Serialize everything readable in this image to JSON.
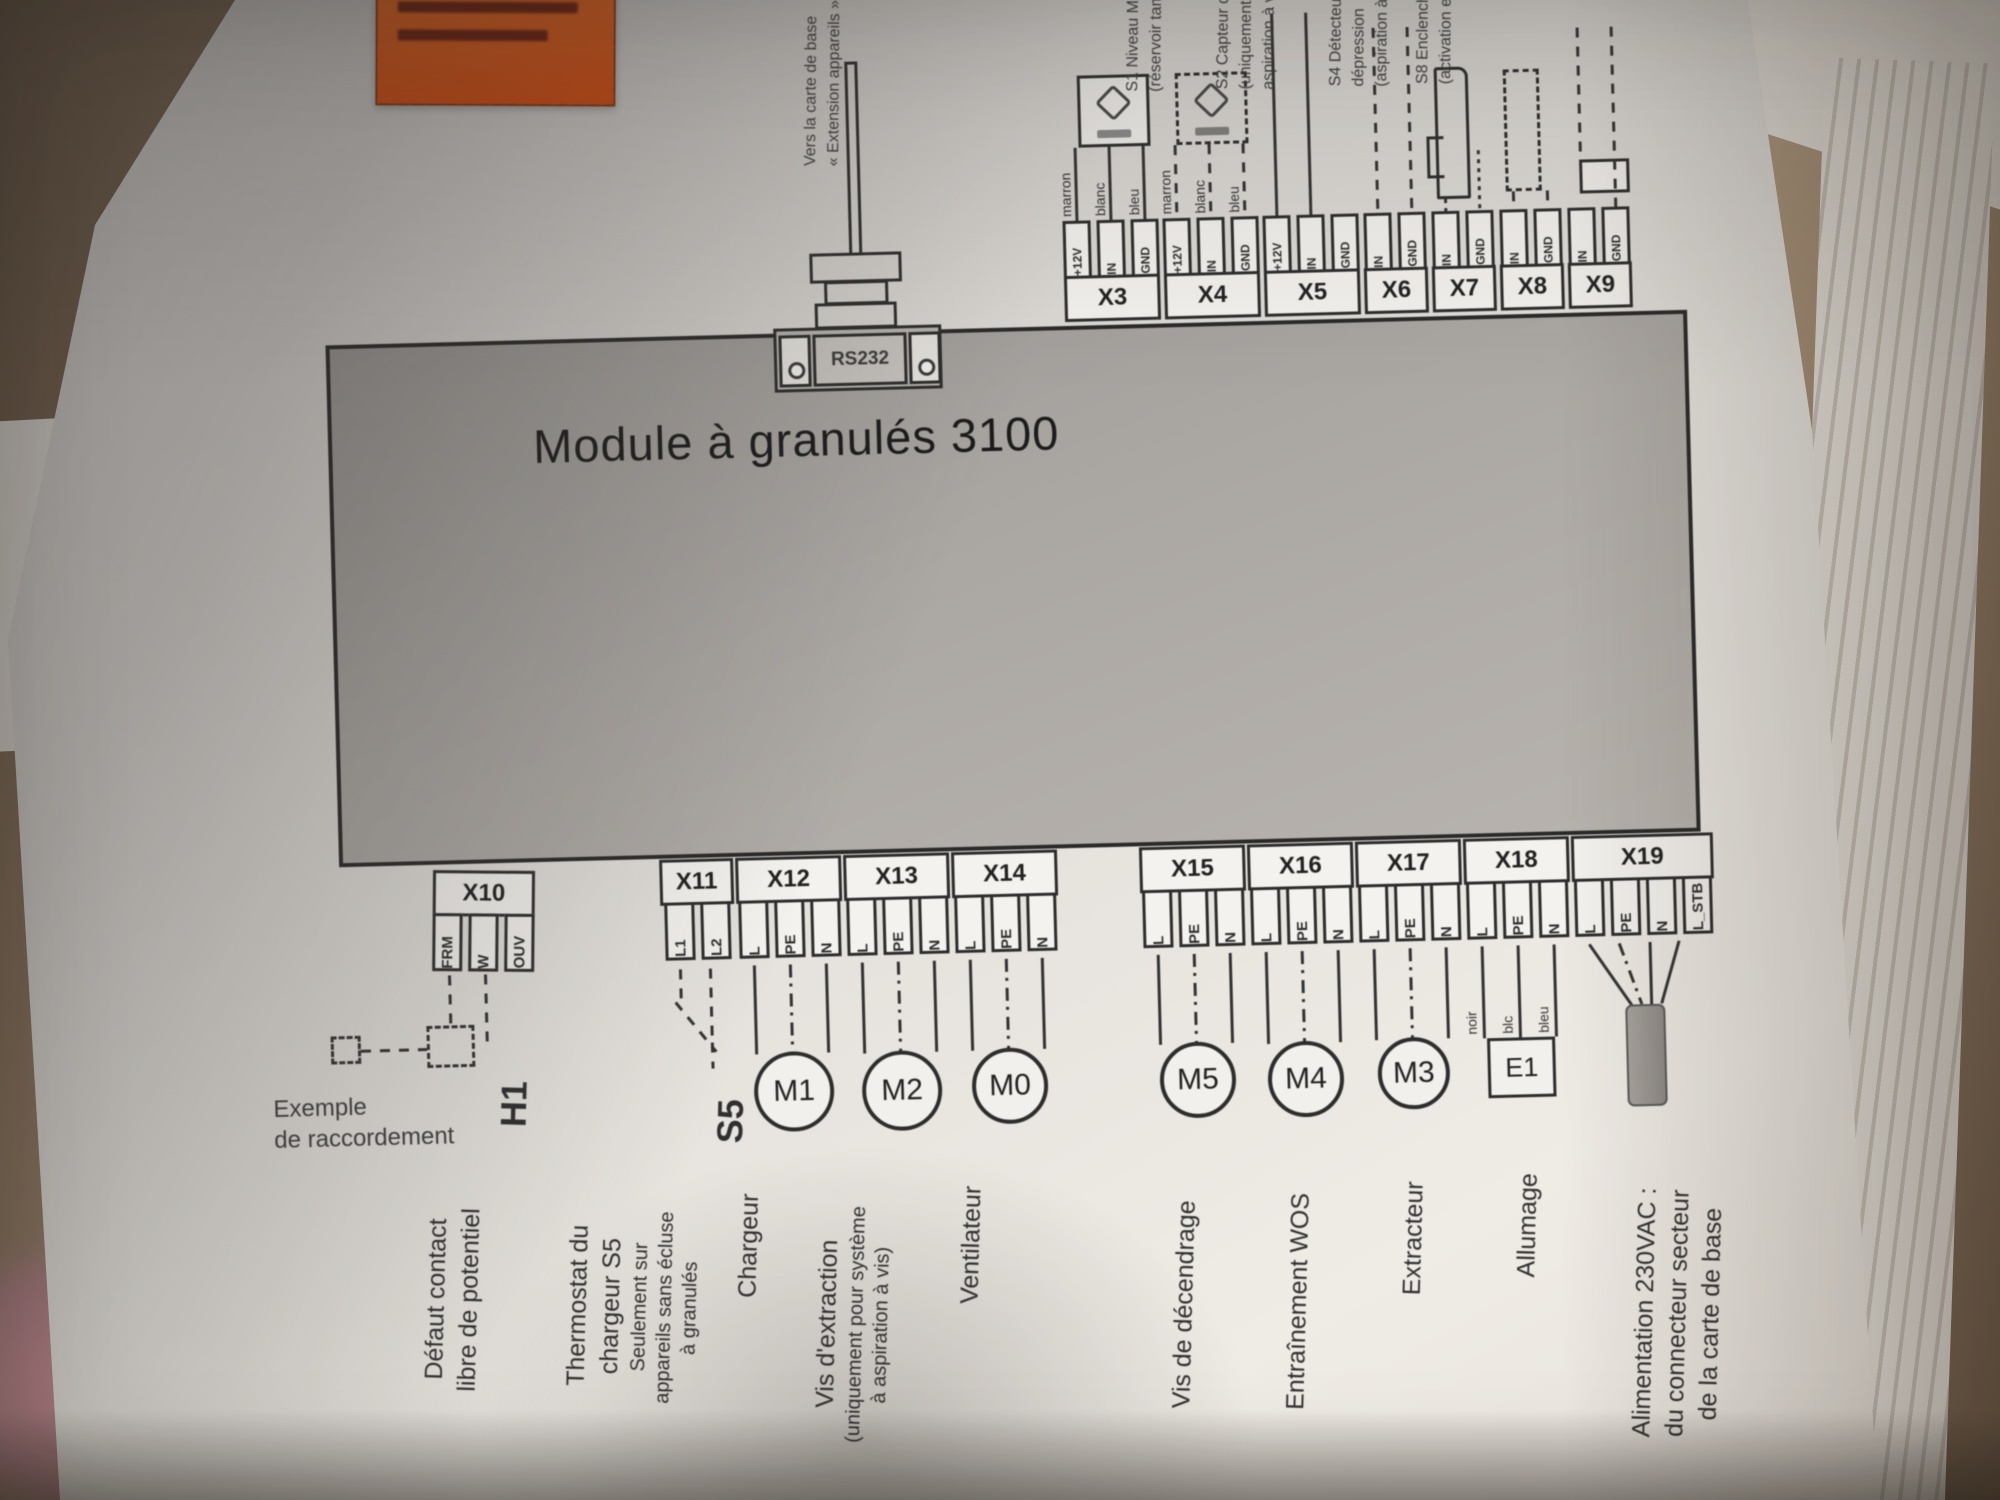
{
  "diagram": {
    "title": "Module à granulés 3100",
    "rs232_label": "RS232",
    "cable_label": {
      "line1": "Vers la carte de base",
      "line2": "« Extension appareils »"
    },
    "top_connectors": [
      {
        "name": "X3",
        "pins": [
          "+12V",
          "IN",
          "GND"
        ]
      },
      {
        "name": "X4",
        "pins": [
          "+12V",
          "IN",
          "GND"
        ]
      },
      {
        "name": "X5",
        "pins": [
          "+12V",
          "IN",
          "GND"
        ]
      },
      {
        "name": "X6",
        "pins": [
          "IN",
          "GND"
        ]
      },
      {
        "name": "X7",
        "pins": [
          "IN",
          "GND"
        ]
      },
      {
        "name": "X8",
        "pins": [
          "IN",
          "GND"
        ]
      },
      {
        "name": "X9",
        "pins": [
          "IN",
          "GND"
        ]
      }
    ],
    "wire_colors_top": [
      "marron",
      "blanc",
      "bleu"
    ],
    "sensor_labels": [
      {
        "id": "S1",
        "lines": [
          "S1 Niveau MAX",
          "(réservoir tampon)"
        ]
      },
      {
        "id": "S2",
        "lines": [
          "S2 Capteur de niveau",
          "(uniquement avec",
          "aspiration à vis)"
        ]
      },
      {
        "id": "S4",
        "lines": [
          "S4 Détecteur de",
          "dépression",
          "(aspiration à vis)"
        ]
      },
      {
        "id": "S8",
        "lines": [
          "S8 Enclenchement",
          "(activation externe)"
        ]
      }
    ],
    "bottom_connectors": [
      {
        "name": "X10",
        "pins": [
          "FRM",
          "W",
          "OUV"
        ]
      },
      {
        "name": "X11",
        "pins": [
          "L1",
          "L2"
        ]
      },
      {
        "name": "X12",
        "pins": [
          "L",
          "PE",
          "N"
        ]
      },
      {
        "name": "X13",
        "pins": [
          "L",
          "PE",
          "N"
        ]
      },
      {
        "name": "X14",
        "pins": [
          "L",
          "PE",
          "N"
        ]
      },
      {
        "name": "X15",
        "pins": [
          "L",
          "PE",
          "N"
        ]
      },
      {
        "name": "X16",
        "pins": [
          "L",
          "PE",
          "N"
        ]
      },
      {
        "name": "X17",
        "pins": [
          "L",
          "PE",
          "N"
        ]
      },
      {
        "name": "X18",
        "pins": [
          "L",
          "PE",
          "N"
        ]
      },
      {
        "name": "X19",
        "pins": [
          "L",
          "PE",
          "N",
          "L_STB"
        ]
      }
    ],
    "wire_colors_x18": [
      "noir",
      "blc",
      "bleu"
    ],
    "devices": [
      {
        "id": "M1"
      },
      {
        "id": "M2"
      },
      {
        "id": "M0"
      },
      {
        "id": "M5"
      },
      {
        "id": "M4"
      },
      {
        "id": "M3"
      },
      {
        "id": "E1"
      }
    ],
    "example_note": {
      "line1": "Exemple",
      "line2": "de raccordement"
    },
    "bottom_labels": [
      {
        "code": "H1",
        "lines": [
          "Défaut contact",
          "libre de potentiel"
        ]
      },
      {
        "code": "S5",
        "lines": [
          "Thermostat du",
          "chargeur S5"
        ],
        "sub": [
          "Seulement sur",
          "appareils sans écluse",
          "à granulés"
        ]
      },
      {
        "lines": [
          "Chargeur"
        ]
      },
      {
        "lines": [
          "Vis d'extraction"
        ],
        "sub": [
          "(uniquement pour système",
          "à aspiration à vis)"
        ]
      },
      {
        "lines": [
          "Ventilateur"
        ]
      },
      {
        "lines": [
          "Vis de décendrage"
        ]
      },
      {
        "lines": [
          "Entraînement WOS"
        ]
      },
      {
        "lines": [
          "Extracteur"
        ]
      },
      {
        "lines": [
          "Allumage"
        ]
      },
      {
        "lines": [
          "Alimentation 230VAC :",
          "du connecteur secteur",
          "de la carte de base"
        ]
      }
    ],
    "colors": {
      "warning_sticker": "#dd5413",
      "module_gray": "#aba7a3",
      "paper": "#e7e4df",
      "line": "#333333"
    }
  }
}
